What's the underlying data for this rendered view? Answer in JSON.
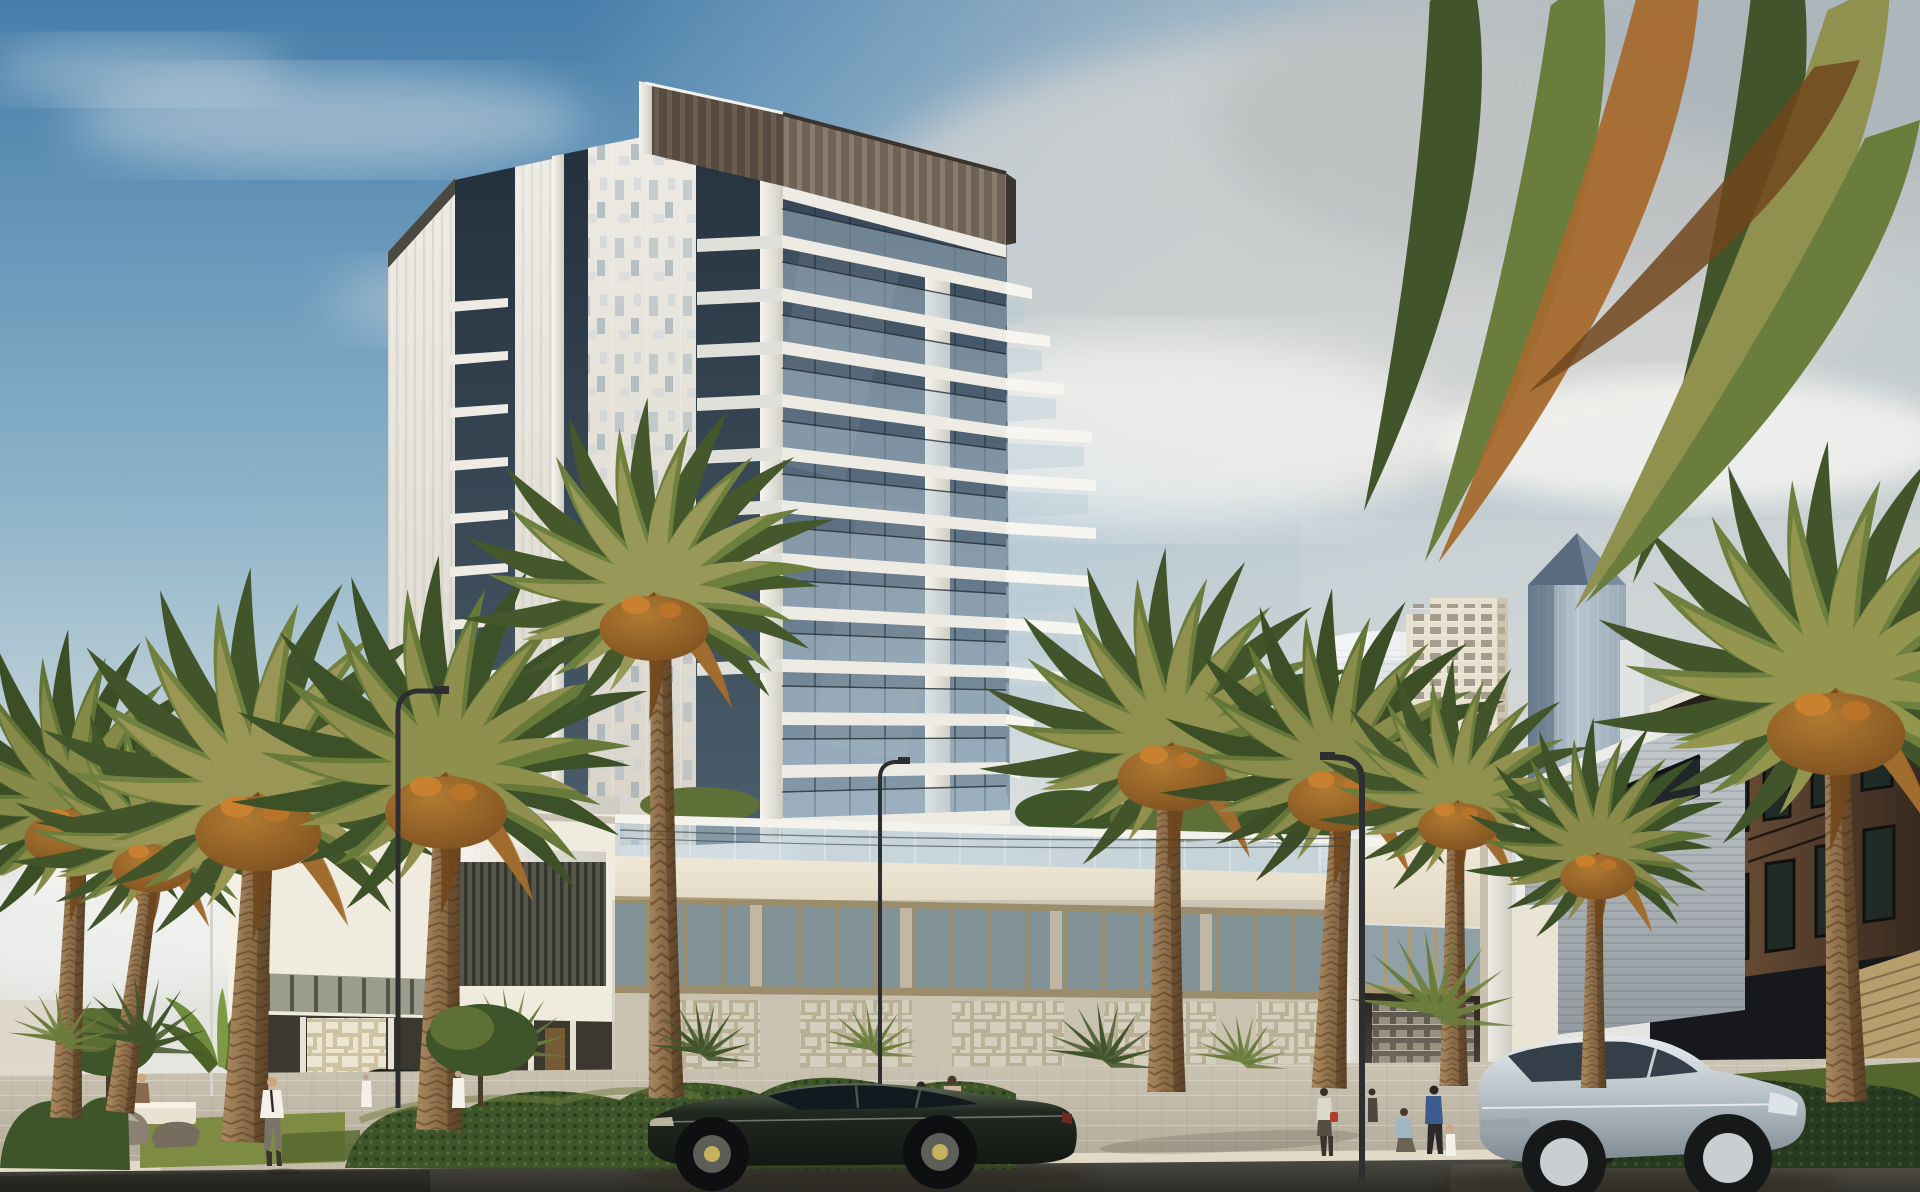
{
  "scene": {
    "type": "architectural-rendering",
    "objects": [
      {
        "name": "main-residential-tower"
      },
      {
        "name": "tower-podium"
      },
      {
        "name": "entrance-portal"
      },
      {
        "name": "cylindrical-glass-tower"
      },
      {
        "name": "beige-grid-tower"
      },
      {
        "name": "pyramid-top-skyscraper"
      },
      {
        "name": "gray-clad-low-building"
      },
      {
        "name": "brown-wood-building"
      },
      {
        "name": "date-palms"
      },
      {
        "name": "overhanging-palm-fronds"
      },
      {
        "name": "dark-fastback-sedan"
      },
      {
        "name": "silver-fastback-car"
      },
      {
        "name": "dark-suv"
      },
      {
        "name": "beige-suv"
      },
      {
        "name": "pedestrians"
      },
      {
        "name": "street-lamps"
      },
      {
        "name": "hedges"
      },
      {
        "name": "boulders"
      },
      {
        "name": "road"
      },
      {
        "name": "sidewalk"
      }
    ]
  },
  "palette": {
    "sky_top": "#467da9",
    "sky_mid": "#8db3ca",
    "sky_horizon": "#dbe0dd",
    "sky_warm": "#ece9e3",
    "cloud_white": "#f7f6f3",
    "cloud_gray": "#d6d5d2",
    "cloud_dark": "#bcbfc0",
    "glass_top": "#2d3e4c",
    "glass_mid": "#4f6375",
    "glass_low": "#879cab",
    "glass_rail": "#b5cad7",
    "face_white": "#edebe4",
    "face_shade": "#d8d4ca",
    "fin": "#f7f5ef",
    "crown": "#6f6257",
    "crown_slat": "#8d7f6f",
    "crown_dark": "#57493f",
    "cream": "#f0e8d7",
    "cream_shade": "#e0d7c2",
    "tan_trim": "#ab9a73",
    "store_glass": "#8fa1a6",
    "olive_glass": "#9c9c8c",
    "mullion_dark": "#4c4f44",
    "louver": "#565748",
    "louver_dark": "#35372e",
    "lattice_bg": "#cec2a2",
    "lattice_fg": "#ece5d2",
    "cyl_hi": "#f3f6f6",
    "cyl_lo": "#c4cfd7",
    "beige_tower": "#e9e1cc",
    "beige_win": "#8e8878",
    "pyr_hi": "#aebfcc",
    "pyr_lo": "#647b8e",
    "pyr_cap": "#41586e",
    "grayb_hi": "#c8cdd0",
    "grayb_lo": "#939ba0",
    "grayb_win": "#20262a",
    "brown_hi": "#7d5b3e",
    "brown_lo": "#382a20",
    "brown_win": "#202a26",
    "khaki": "#b69e6d",
    "hedge_dark": "#283a20",
    "hedge_mid": "#3e5529",
    "hedge_hi": "#637a35",
    "grass_hi": "#7d8c42",
    "grass_lo": "#55652e",
    "palm_dk": "#42552a",
    "palm_md": "#6b7d3c",
    "palm_lt": "#90914f",
    "palm_rust": "#a56a2e",
    "skirt_hi": "#b07a31",
    "skirt_lo": "#71461c",
    "trunk_hi": "#ab8a60",
    "trunk_lo": "#6e5134",
    "pave_hi": "#cdc5b4",
    "pave_lo": "#b0a897",
    "curb": "#e2dac6",
    "road_hi": "#4e4c46",
    "road_lo": "#2c2b27",
    "lamp": "#2c2e2f",
    "wire": "#3c4144",
    "sedan": "#212720",
    "sedan_hi": "#5f6a5c",
    "sedan_win": "#131a1f",
    "silver_hi": "#e9edf0",
    "silver_md": "#b4bec5",
    "silver_lo": "#7e8991",
    "win_dark": "#343f49",
    "suv_beige": "#bfb198",
    "suv_dark": "#25272a",
    "p_white": "#f3f1ea",
    "p_green": "#41804a",
    "p_beige": "#cab59a",
    "p_red": "#b23b2e",
    "p_blue": "#3c5c8e",
    "p_gray": "#7c7669",
    "skin": "#cfa57e",
    "shadow": "#262318",
    "haze": "#e9e7e2",
    "glow": "#c0893f"
  }
}
